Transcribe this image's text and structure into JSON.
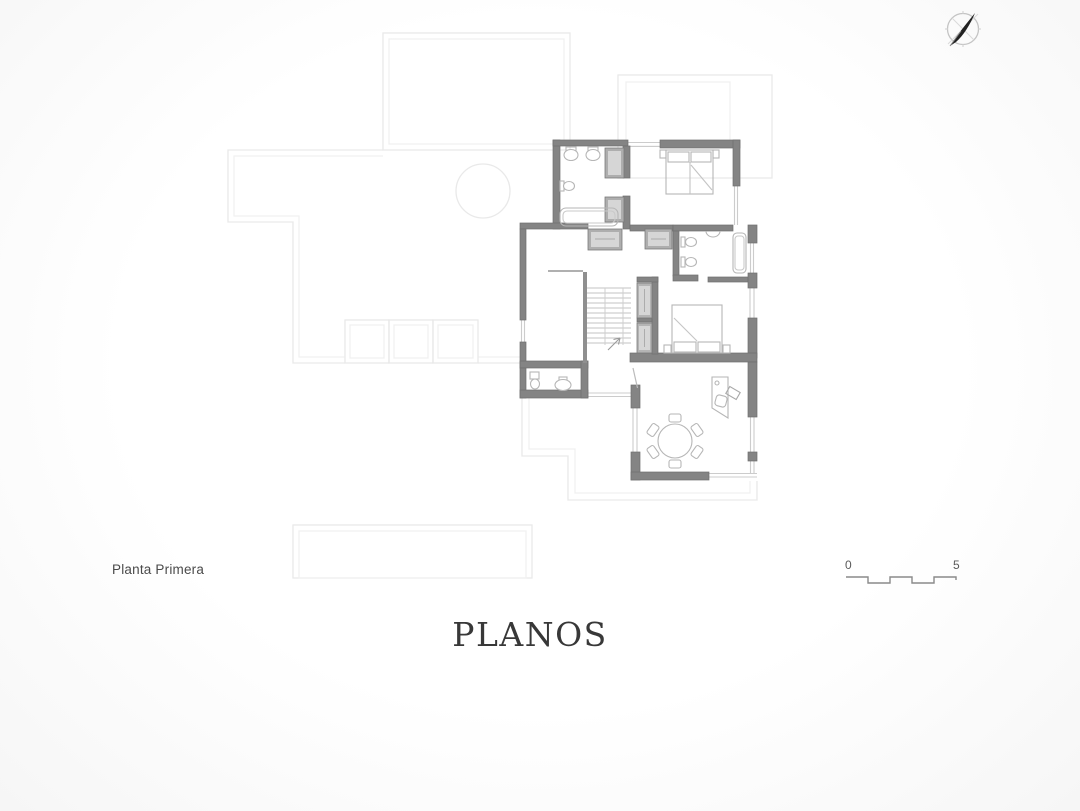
{
  "sheet": {
    "floor_label": "Planta Primera",
    "title": "PLANOS",
    "scale_bar": {
      "start_label": "0",
      "end_label": "5"
    },
    "north_arrow_icon": "north-arrow"
  },
  "colors": {
    "background": "#fbfbfb",
    "wall": "#848484",
    "wall_edge": "#6f6f6f",
    "partition": "#8f8f8f",
    "closet_fill": "#aeaeae",
    "closet_inner": "#d6d6d6",
    "fixture": "#b6b6b6",
    "stairs": "#c3c3c3",
    "ghost_outline": "#e9e9e9",
    "label_text": "#4a4a4a",
    "title_text": "#383838",
    "compass_needle": "#222222"
  }
}
